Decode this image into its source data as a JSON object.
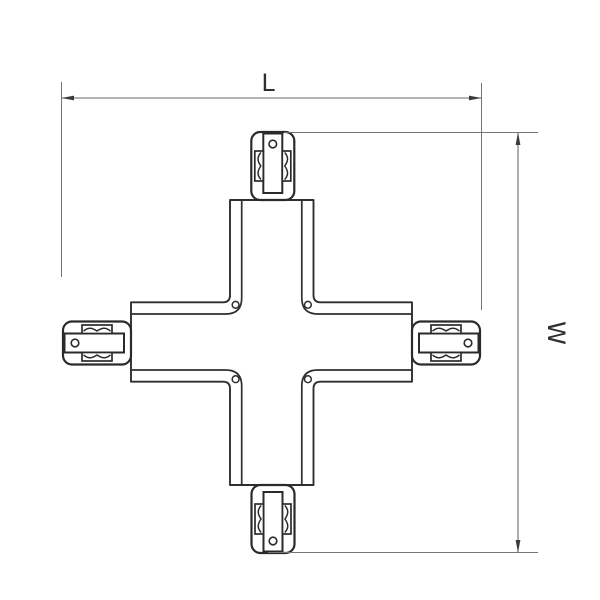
{
  "diagram": {
    "description": "technical line drawing of an X-shaped track connector, top view, with overall dimensions",
    "dimension_labels": {
      "length": "L",
      "width": "W"
    },
    "style": {
      "line_color": "#2f2f2f",
      "dimension_color": "#757575",
      "background": "#ffffff"
    }
  }
}
